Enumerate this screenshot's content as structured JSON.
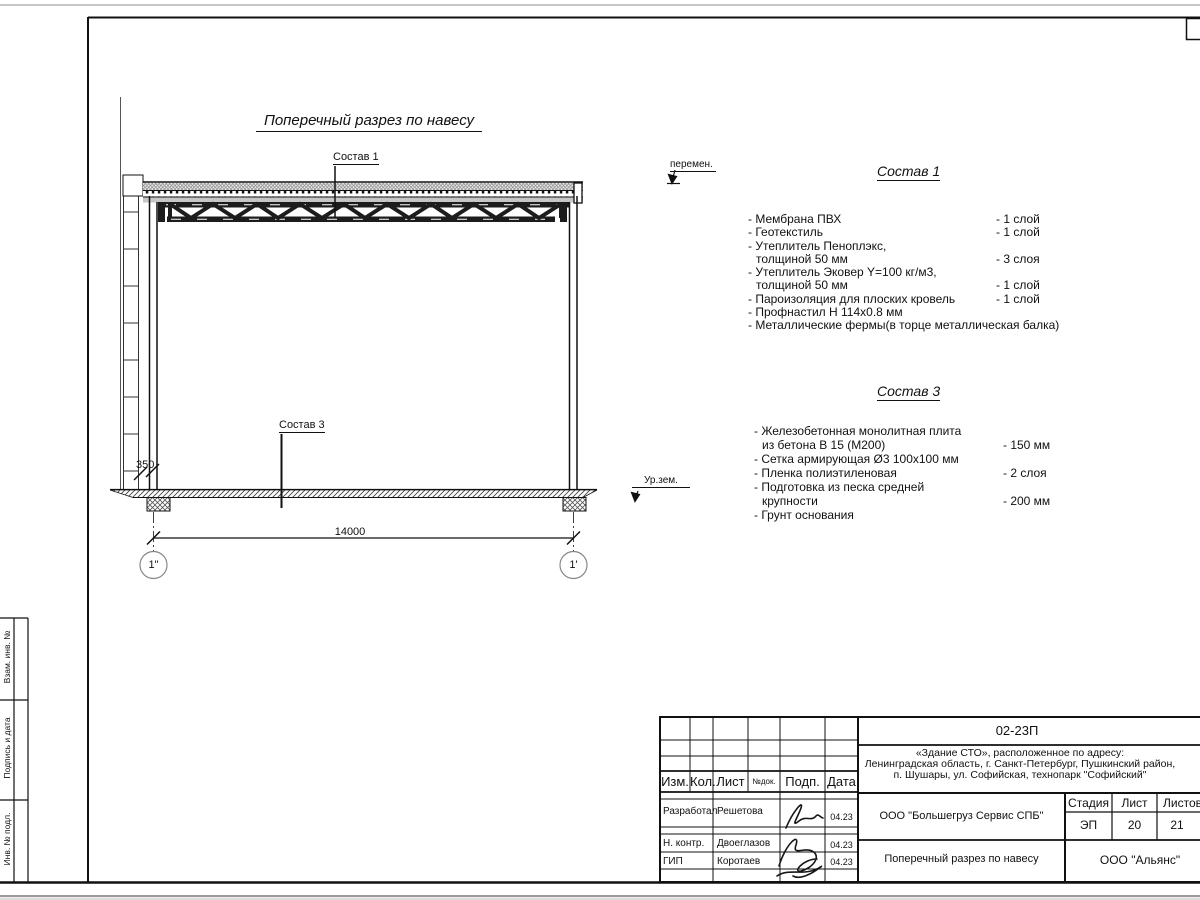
{
  "drawing": {
    "title": "Поперечный разрез по навесу",
    "sostav1_label": "Состав 1",
    "sostav3_label": "Состав 3",
    "peremen_label": "перемен.",
    "ground_label": "Ур.зем.",
    "dim_width": "14000",
    "dim_offset": "350",
    "axis_left": "1\"",
    "axis_right": "1'"
  },
  "sostav1": {
    "title": "Состав 1",
    "items": [
      {
        "name": "- Мембрана ПВХ",
        "qty": "- 1 слой"
      },
      {
        "name": "- Геотекстиль",
        "qty": "- 1 слой"
      },
      {
        "name": "- Утеплитель Пеноплэкс,",
        "qty": ""
      },
      {
        "name": "толщиной 50 мм",
        "qty": "- 3 слоя"
      },
      {
        "name": "- Утеплитель Эковер Y=100 кг/м3,",
        "qty": ""
      },
      {
        "name": "толщиной 50 мм",
        "qty": "- 1 слой"
      },
      {
        "name": "- Пароизоляция для плоских кровель",
        "qty": "- 1 слой"
      },
      {
        "name": "- Профнастил Н 114х0.8 мм",
        "qty": ""
      },
      {
        "name": "- Металлические фермы(в торце металлическая балка)",
        "qty": ""
      }
    ]
  },
  "sostav3": {
    "title": "Состав 3",
    "items": [
      {
        "name": "- Железобетонная  монолитная плита",
        "qty": ""
      },
      {
        "name": "из бетона В 15 (М200)",
        "qty": "- 150 мм"
      },
      {
        "name": "- Сетка армирующая Ø3 100х100 мм",
        "qty": ""
      },
      {
        "name": "- Пленка полиэтиленовая",
        "qty": "-  2 слоя"
      },
      {
        "name": "- Подготовка из песка средней",
        "qty": ""
      },
      {
        "name": "крупности",
        "qty": "- 200 мм"
      },
      {
        "name": "- Грунт основания",
        "qty": ""
      }
    ]
  },
  "stamp": {
    "code": "02-23П",
    "object_lines": [
      "«Здание СТО», расположенное по адресу:",
      "Ленинградская область, г. Санкт-Петербург, Пушкинский район,",
      "п. Шушары, ул. Софийская, технопарк \"Софийский\""
    ],
    "cols": {
      "izm": "Изм.",
      "kol": "Кол.",
      "list": "Лист",
      "ndok": "№док.",
      "podp": "Подп.",
      "data": "Дата"
    },
    "rows": [
      {
        "role": "Разработал",
        "name": "Решетова",
        "date": "04.23"
      },
      {
        "role": "Н. контр.",
        "name": "Двоеглазов",
        "date": "04.23"
      },
      {
        "role": "ГИП",
        "name": "Коротаев",
        "date": "04.23"
      }
    ],
    "company": "ООО \"Большегруз Сервис СПБ\"",
    "stage_label": "Стадия",
    "sheet_label": "Лист",
    "sheets_label": "Листов",
    "stage": "ЭП",
    "sheet_num": "20",
    "sheets_total": "21",
    "doc_title": "Поперечный разрез по навесу",
    "org": "ООО \"Альянс\""
  },
  "margin": {
    "labels": [
      "Взам. инв. №",
      "Подпись и дата",
      "Инв. № подл."
    ]
  }
}
